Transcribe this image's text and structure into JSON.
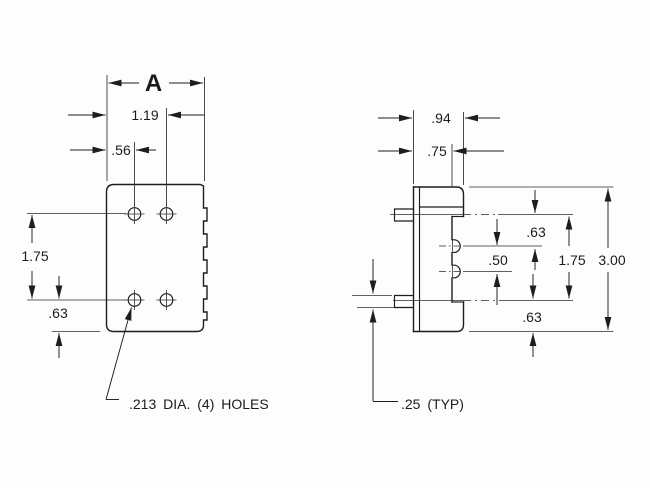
{
  "drawing": {
    "ink_color": "#1d1d1d",
    "bg_color": "#fdfdfd",
    "front_view": {
      "dim_overall_width": "A",
      "dim_hole_span": "1.19",
      "dim_hole_offset": ".56",
      "dim_hole_row_span": "1.75",
      "dim_bottom_offset": ".63",
      "holes_note": ".213 DIA. (4) HOLES"
    },
    "side_view": {
      "dim_depth_overall": ".94",
      "dim_depth_body": ".75",
      "dim_top_to_pin": ".63",
      "dim_pin_pitch": ".50",
      "dim_row_span": "1.75",
      "dim_overall_height": "3.00",
      "dim_bottom_offset": ".63",
      "dim_ear_thickness": ".25 (TYP)"
    }
  }
}
